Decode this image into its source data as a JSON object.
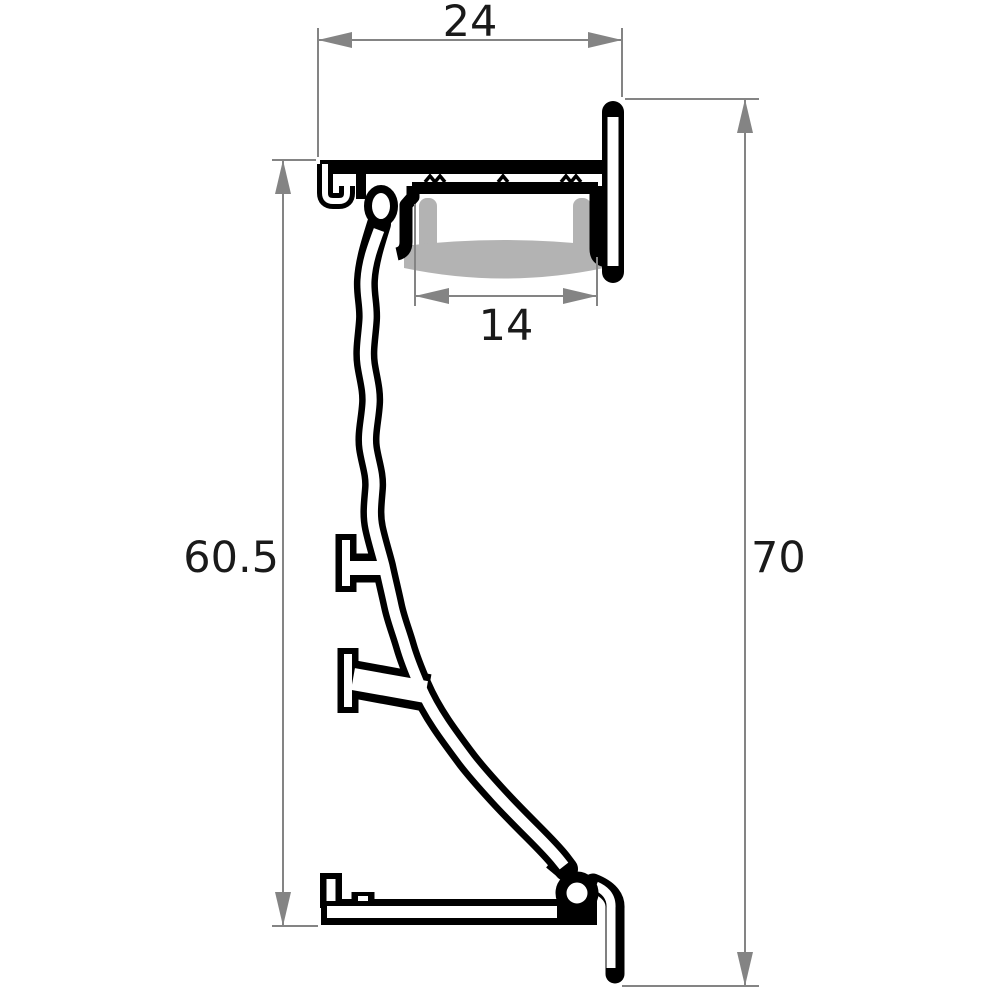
{
  "drawing": {
    "type": "technical-cross-section",
    "subject": "wall-mounted-aluminium-led-profile",
    "colors": {
      "outline": "#000000",
      "dimension_lines": "#848484",
      "diffuser": "#b3b3b3",
      "text": "#1a1a1a",
      "background": "#ffffff"
    },
    "dimensions": {
      "top_width": {
        "label": "24"
      },
      "inner_width": {
        "label": "14"
      },
      "left_height": {
        "label": "60.5"
      },
      "right_height": {
        "label": "70"
      }
    }
  }
}
